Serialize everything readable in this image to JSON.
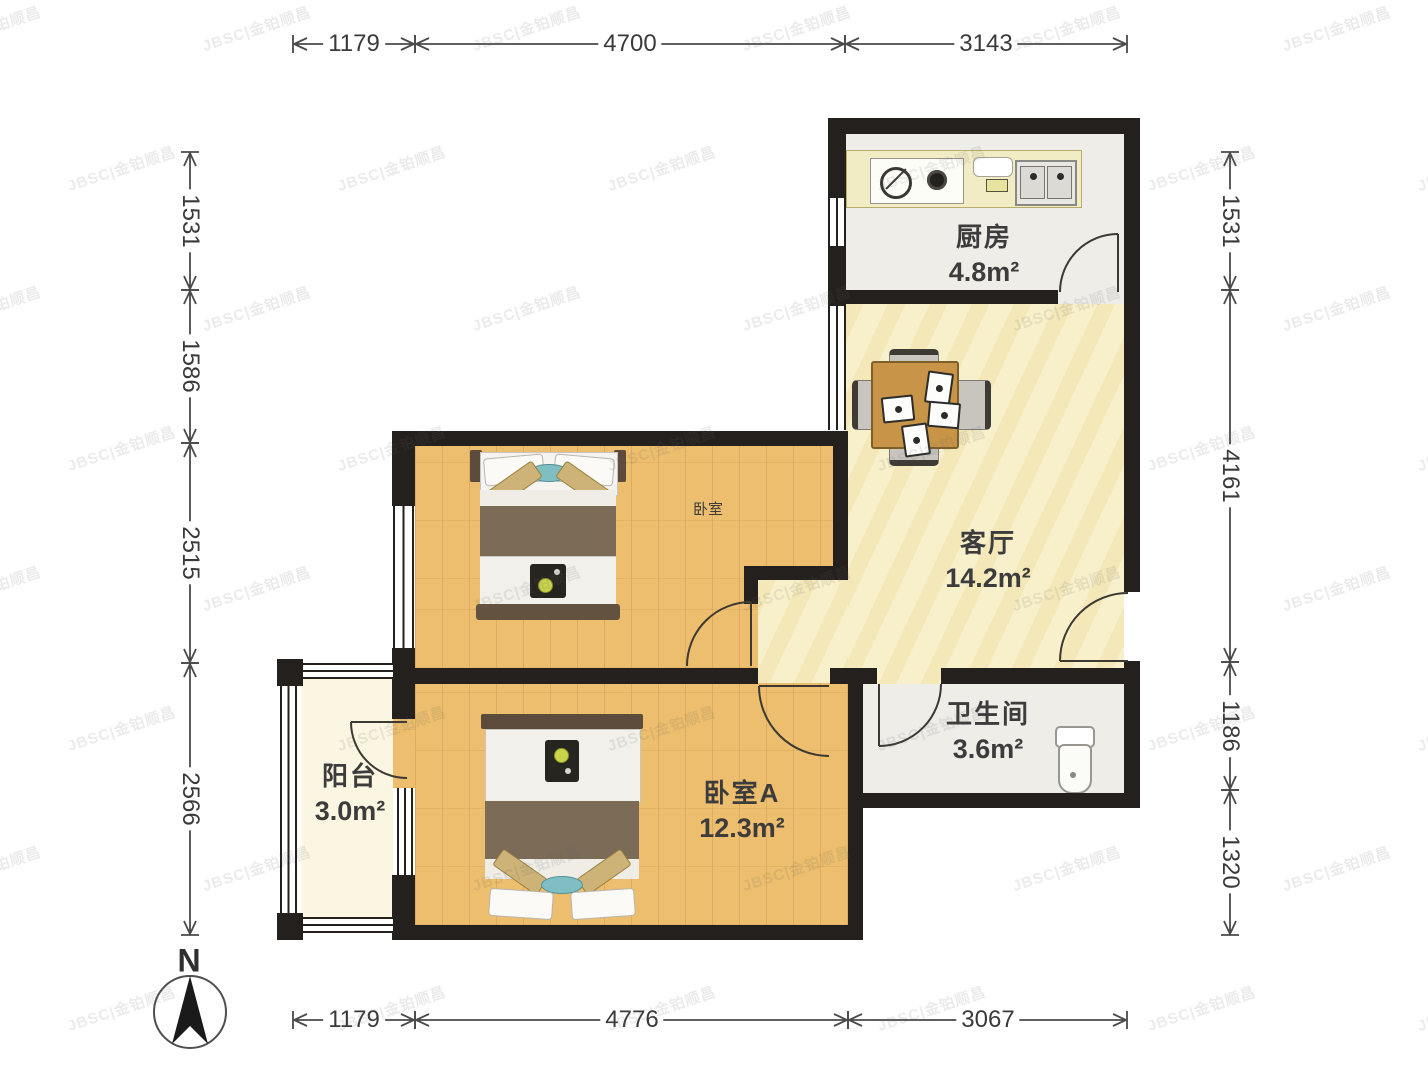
{
  "watermark": {
    "text": "JBSC|金铂顺昌"
  },
  "compass": {
    "label": "N"
  },
  "rooms": {
    "kitchen": {
      "name": "厨房",
      "area": "4.8m²"
    },
    "living": {
      "name": "客厅",
      "area": "14.2m²"
    },
    "bedroom": {
      "name": "卧室",
      "area": ""
    },
    "bedroom_a": {
      "name": "卧室A",
      "area": "12.3m²"
    },
    "bathroom": {
      "name": "卫生间",
      "area": "3.6m²"
    },
    "balcony": {
      "name": "阳台",
      "area": "3.0m²"
    }
  },
  "dimensions": {
    "top": [
      "1179",
      "4700",
      "3143"
    ],
    "bottom": [
      "1179",
      "4776",
      "3067"
    ],
    "left": [
      "1531",
      "1586",
      "2515",
      "2566"
    ],
    "right": [
      "1531",
      "4161",
      "1186",
      "1320"
    ]
  },
  "colors": {
    "wall": "#23201d",
    "wood_floor": "#ECBE6E",
    "living_floor": "#F7EEC5",
    "balcony_floor": "#FAF6E2",
    "tile_floor": "#EFEDE8",
    "counter": "#F2ECC5",
    "table": "#C89548",
    "blanket": "#7B6B57",
    "teal_accent": "#7FBFC4",
    "dimension_text": "#3a3a3a"
  }
}
